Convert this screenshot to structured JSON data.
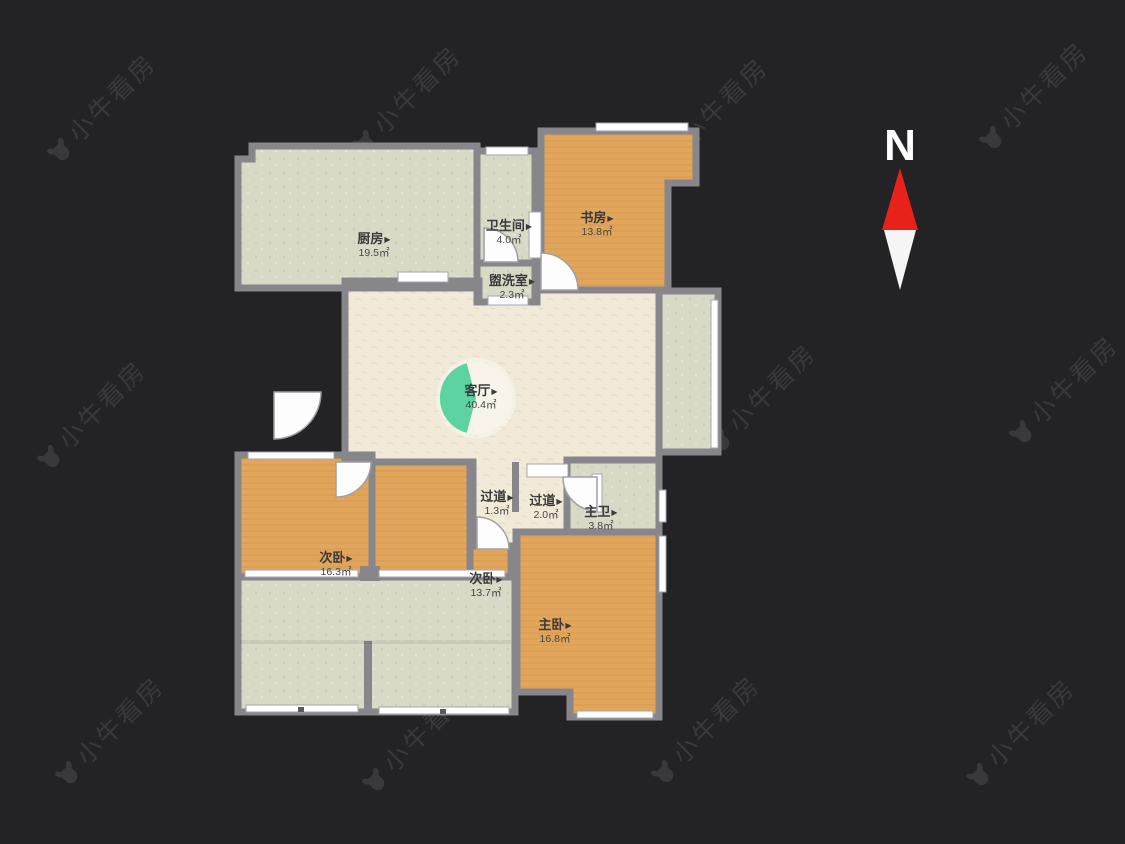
{
  "watermark": {
    "text": "小牛看房"
  },
  "compass": {
    "label": "N"
  },
  "labels": {
    "marker": "▶"
  },
  "rooms": [
    {
      "id": "kitchen",
      "name": "厨房",
      "area": "19.5㎡"
    },
    {
      "id": "bathroom",
      "name": "卫生间",
      "area": "4.0㎡"
    },
    {
      "id": "study",
      "name": "书房",
      "area": "13.8㎡"
    },
    {
      "id": "washroom",
      "name": "盥洗室",
      "area": "2.3㎡"
    },
    {
      "id": "living-room",
      "name": "客厅",
      "area": "40.4㎡"
    },
    {
      "id": "corridor-1",
      "name": "过道",
      "area": "1.3㎡"
    },
    {
      "id": "corridor-2",
      "name": "过道",
      "area": "2.0㎡"
    },
    {
      "id": "master-bath",
      "name": "主卫",
      "area": "3.8㎡"
    },
    {
      "id": "bedroom-left",
      "name": "次卧",
      "area": "16.3㎡"
    },
    {
      "id": "bedroom-middle",
      "name": "次卧",
      "area": "13.7㎡"
    },
    {
      "id": "master-bedroom",
      "name": "主卧",
      "area": "16.8㎡"
    }
  ],
  "colors": {
    "background": "#232325",
    "wall": "#87878b",
    "room_green": "#d9dac6",
    "room_cream": "#f1ead8",
    "room_wood": "#e2a55c",
    "accent_teal": "#5ed3a2",
    "compass_red": "#e8211a",
    "label_text": "#3a3a3a",
    "window_white": "#ffffff"
  }
}
